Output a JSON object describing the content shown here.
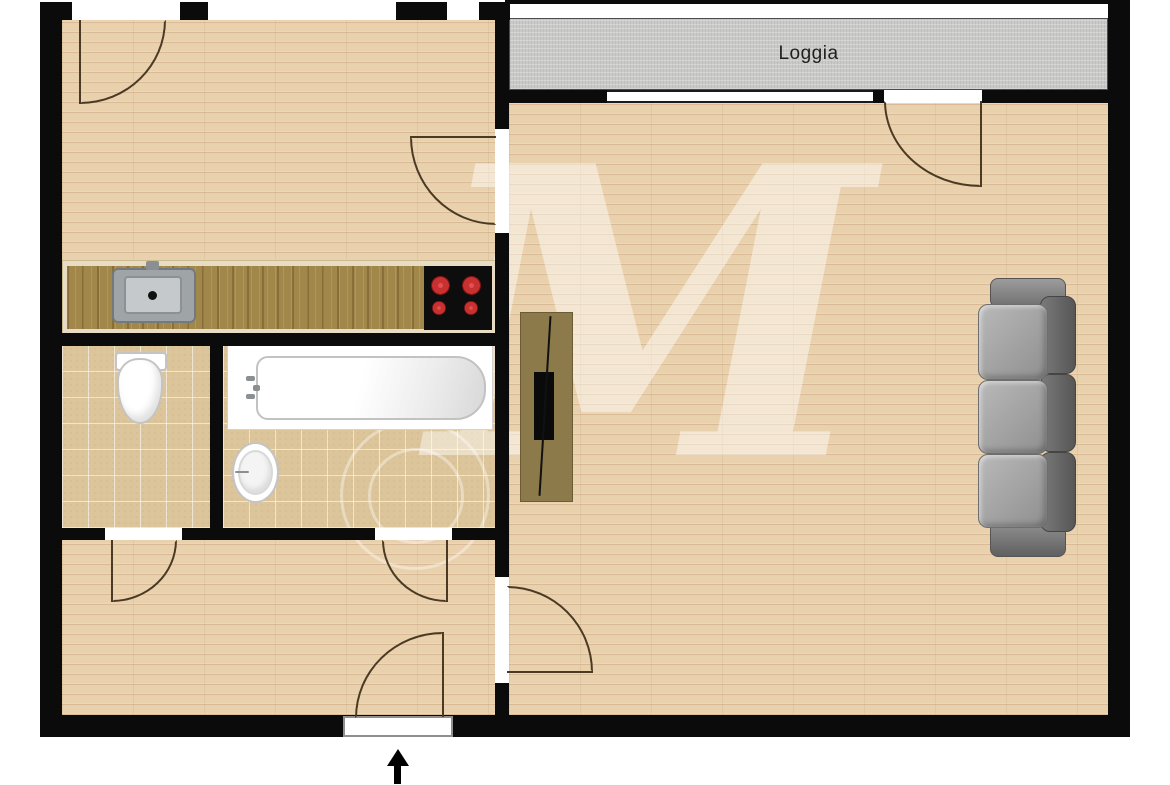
{
  "plan": {
    "type": "apartment-floor-plan",
    "labels": {
      "loggia": "Loggia"
    },
    "rooms_depicted": [
      "kitchen",
      "wc",
      "bathroom",
      "hallway",
      "living-room",
      "loggia"
    ],
    "fixtures_depicted": [
      "kitchen-counter",
      "kitchen-sink",
      "stove-4-burners",
      "toilet",
      "bathtub",
      "wash-basin",
      "tv-stand",
      "tv",
      "sofa-3-seat"
    ],
    "entrance_indicator": "arrow-up-at-bottom-door"
  },
  "colors": {
    "wall": "#0b0b0b",
    "wood-floor": "#ead1ae",
    "tile-floor": "#dcc59b",
    "loggia-floor": "#c9c9c7",
    "counter-top": "#a2874a",
    "counter-edge": "#e8dcc4",
    "sink-gray": "#9fa4a7",
    "stove-black": "#0d0d0d",
    "burner-red": "#c93030",
    "fixture-outline": "#c4c4c4",
    "sofa-seat": "#adadad",
    "sofa-back": "#636363",
    "tv-stand": "#8d7a4a",
    "tv-black": "#0a0a0a",
    "door-arc": "#4a3a24",
    "watermark": "rgba(255,255,255,0.45)",
    "label-text": "#1f1f1f"
  }
}
